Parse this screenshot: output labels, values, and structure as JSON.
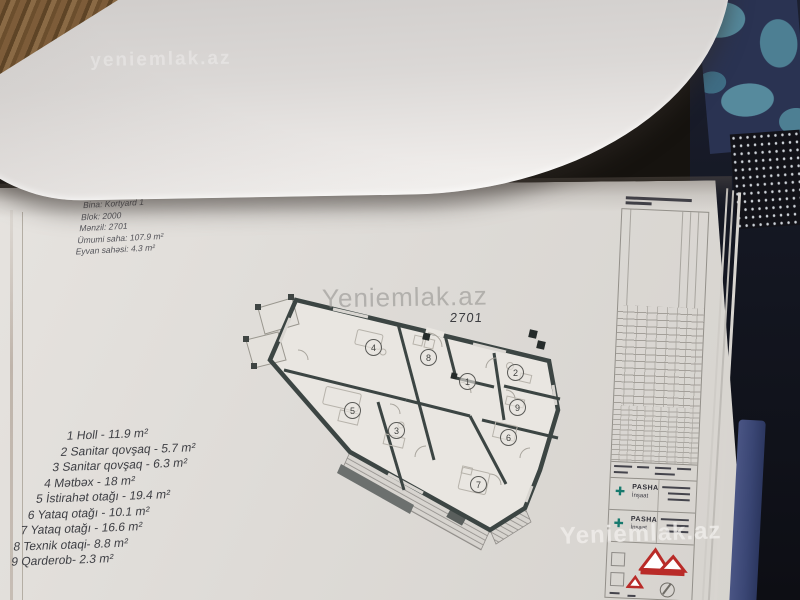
{
  "watermarks": {
    "main": "Yeniemlak.az",
    "small": "yeniemlak.az"
  },
  "apartment_info": {
    "lines": [
      "Bina: Kortyard 1",
      "Blok: 2000",
      "Mənzil: 2701",
      "Ümumi saha: 107.9 m²",
      "Eyvan sahəsi: 4.3 m²"
    ]
  },
  "plan": {
    "label": "2701",
    "room_numbers": [
      "1",
      "2",
      "3",
      "4",
      "5",
      "6",
      "7",
      "8",
      "9"
    ]
  },
  "room_list": {
    "items": [
      "1 Holl - 11.9 m²",
      "2 Sanitar qovşaq - 5.7 m²",
      "3 Sanitar qovşaq - 6.3 m²",
      "4 Mətbəx - 18 m²",
      "5 İstirahət otağı - 19.4 m²",
      "6 Yataq otağı - 10.1 m²",
      "7 Yataq otağı - 16.6 m²",
      "8 Texnik otaqi- 8.8 m²",
      "9 Qarderob- 2.3 m²"
    ]
  },
  "title_block": {
    "company_rows": [
      {
        "name": "PASHA",
        "sub": "İnşaat"
      },
      {
        "name": "PASHA",
        "sub": "İnşaat"
      }
    ]
  },
  "colors": {
    "wall": "#3c4543",
    "accent_teal": "#177a6e",
    "logo_red": "#b92b28",
    "book_edge_blue": "#46517f",
    "fabric_navy": "#2a3352",
    "fabric_teal": "#55899c"
  }
}
